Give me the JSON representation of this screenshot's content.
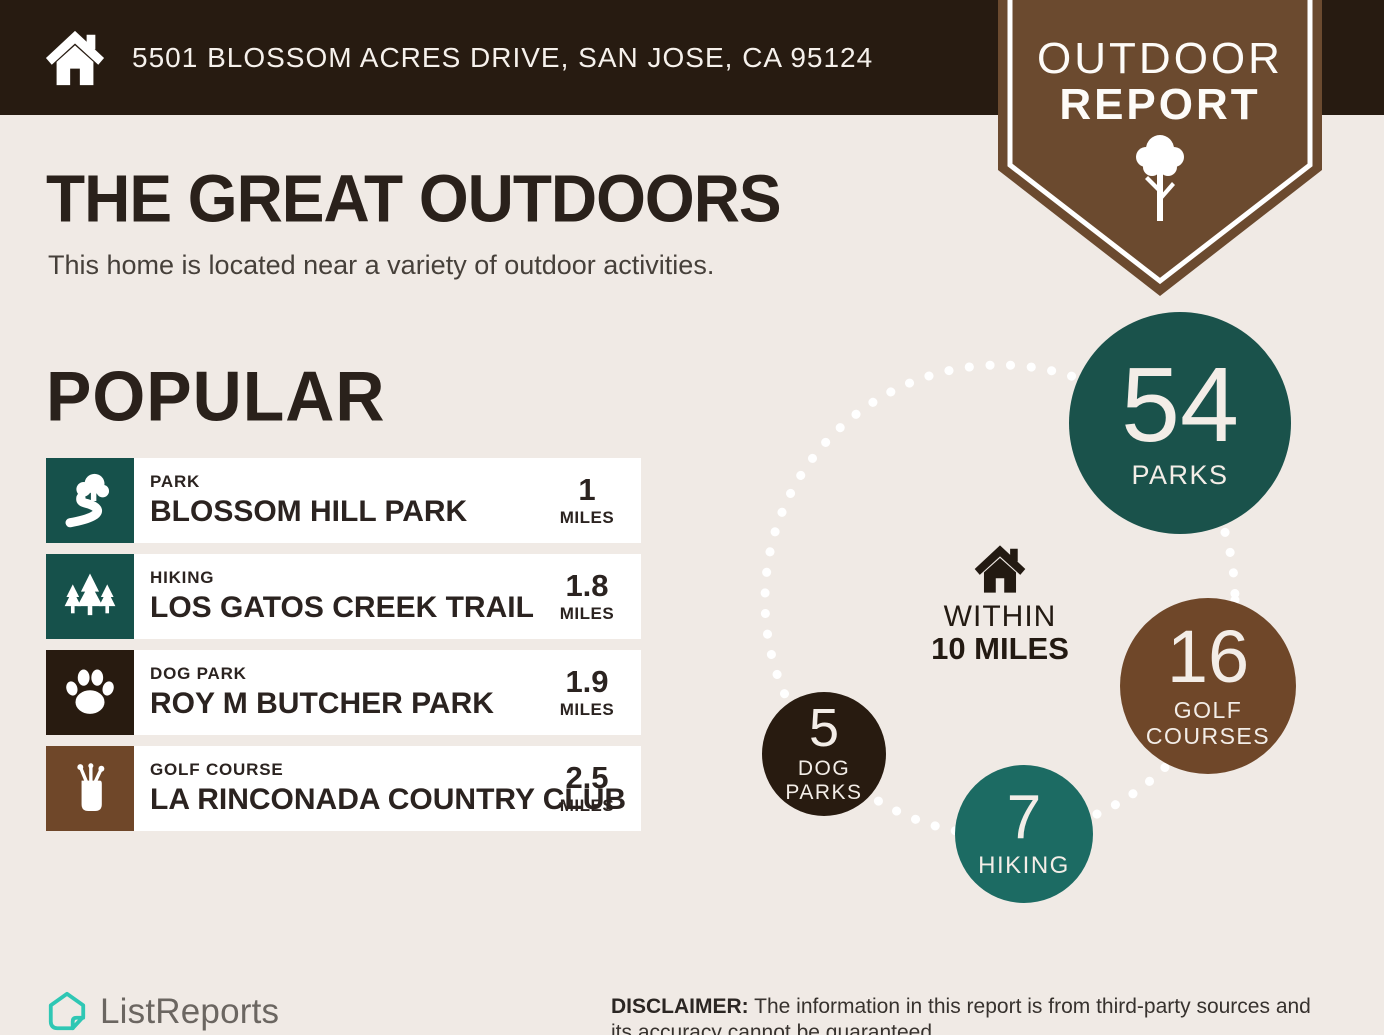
{
  "header": {
    "address": "5501 BLOSSOM ACRES DRIVE, SAN JOSE, CA 95124",
    "badge": {
      "line1": "OUTDOOR",
      "line2": "REPORT"
    }
  },
  "intro": {
    "title": "THE GREAT OUTDOORS",
    "subtitle": "This home is located near a variety of outdoor activities."
  },
  "popular": {
    "heading": "POPULAR",
    "items": [
      {
        "category": "PARK",
        "name": "BLOSSOM HILL PARK",
        "distance": "1",
        "unit": "MILES",
        "icon": "park-icon",
        "tile_color": "#16514b"
      },
      {
        "category": "HIKING",
        "name": "LOS GATOS CREEK TRAIL",
        "distance": "1.8",
        "unit": "MILES",
        "icon": "pine-trees-icon",
        "tile_color": "#16514b"
      },
      {
        "category": "DOG PARK",
        "name": "ROY M BUTCHER PARK",
        "distance": "1.9",
        "unit": "MILES",
        "icon": "paw-icon",
        "tile_color": "#281b10"
      },
      {
        "category": "GOLF COURSE",
        "name": "LA RINCONADA COUNTRY CLUB",
        "distance": "2.5",
        "unit": "MILES",
        "icon": "golf-bag-icon",
        "tile_color": "#6f4729"
      }
    ]
  },
  "radius_chart": {
    "type": "bubble",
    "center": {
      "line1": "WITHIN",
      "line2": "10 MILES"
    },
    "bubbles": [
      {
        "value": "54",
        "label": "PARKS",
        "color": "#1a524b"
      },
      {
        "value": "16",
        "label": "GOLF COURSES",
        "color": "#6f4729"
      },
      {
        "value": "5",
        "label": "DOG PARKS",
        "color": "#281b10"
      },
      {
        "value": "7",
        "label": "HIKING",
        "color": "#1c6b63"
      }
    ]
  },
  "footer": {
    "brand": "ListReports",
    "disclaimer_label": "DISCLAIMER:",
    "disclaimer_text": " The information in this report is from third-party sources and its accuracy cannot be guaranteed."
  },
  "colors": {
    "background": "#f0eae5",
    "header_bar": "#271b11",
    "badge_brown": "#6b4a2f",
    "teal_dark": "#1a524b",
    "teal_mid": "#1c6b63",
    "brown": "#6f4729",
    "dark_chocolate": "#281b10",
    "logo_teal": "#2fc7b4"
  }
}
